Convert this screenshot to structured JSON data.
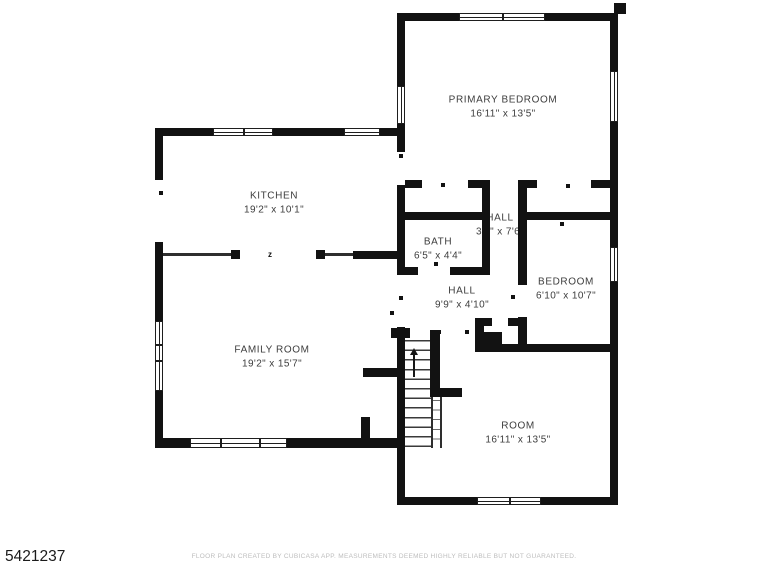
{
  "meta": {
    "background": "#ffffff",
    "wall_color": "#121212",
    "label_color": "#3d3d3d"
  },
  "rooms": [
    {
      "id": "primary-bedroom",
      "name": "PRIMARY BEDROOM",
      "dims": "16'11\" x 13'5\"",
      "cx": 503,
      "cy": 107
    },
    {
      "id": "kitchen",
      "name": "KITCHEN",
      "dims": "19'2\" x 10'1\"",
      "cx": 274,
      "cy": 203
    },
    {
      "id": "family-room",
      "name": "FAMILY ROOM",
      "dims": "19'2\" x 15'7\"",
      "cx": 272,
      "cy": 357
    },
    {
      "id": "bath",
      "name": "BATH",
      "dims": "6'5\" x 4'4\"",
      "cx": 438,
      "cy": 249
    },
    {
      "id": "hall-upper",
      "name": "HALL",
      "dims": "3'0\" x 7'6\"",
      "cx": 500,
      "cy": 225
    },
    {
      "id": "bedroom",
      "name": "BEDROOM",
      "dims": "6'10\" x 10'7\"",
      "cx": 566,
      "cy": 289
    },
    {
      "id": "hall-lower",
      "name": "HALL",
      "dims": "9'9\" x 4'10\"",
      "cx": 462,
      "cy": 298
    },
    {
      "id": "room",
      "name": "ROOM",
      "dims": "16'11\" x 13'5\"",
      "cx": 518,
      "cy": 433
    }
  ],
  "walls": [
    [
      610,
      13,
      8,
      492
    ],
    [
      397,
      13,
      8,
      492
    ],
    [
      155,
      128,
      8,
      320
    ],
    [
      482,
      188,
      8,
      87
    ],
    [
      518,
      180,
      9,
      172
    ],
    [
      430,
      330,
      10,
      67
    ],
    [
      361,
      417,
      9,
      27
    ],
    [
      475,
      318,
      9,
      34
    ],
    [
      397,
      13,
      221,
      8
    ],
    [
      614,
      3,
      12,
      11
    ],
    [
      155,
      128,
      250,
      8
    ],
    [
      397,
      180,
      221,
      8
    ],
    [
      397,
      212,
      93,
      8
    ],
    [
      518,
      212,
      100,
      8
    ],
    [
      397,
      267,
      93,
      8
    ],
    [
      231,
      250,
      9,
      9
    ],
    [
      316,
      250,
      9,
      9
    ],
    [
      353,
      251,
      52,
      8
    ],
    [
      155,
      438,
      250,
      10
    ],
    [
      475,
      344,
      143,
      8
    ],
    [
      475,
      318,
      17,
      8
    ],
    [
      508,
      318,
      19,
      8
    ],
    [
      391,
      328,
      19,
      10
    ],
    [
      430,
      388,
      32,
      9
    ],
    [
      363,
      368,
      42,
      9
    ],
    [
      397,
      497,
      221,
      8
    ],
    [
      475,
      332,
      27,
      16
    ]
  ],
  "thin_lines": [
    [
      163,
      253,
      68,
      3
    ],
    [
      325,
      253,
      28,
      3
    ],
    [
      431,
      397,
      2,
      51
    ],
    [
      440,
      397,
      2,
      51
    ]
  ],
  "gaps": [
    [
      397,
      152,
      8,
      33
    ],
    [
      155,
      180,
      8,
      62
    ],
    [
      397,
      275,
      8,
      52
    ],
    [
      422,
      180,
      46,
      8
    ],
    [
      490,
      180,
      28,
      8
    ],
    [
      537,
      180,
      54,
      8
    ],
    [
      418,
      267,
      32,
      8
    ],
    [
      518,
      285,
      9,
      32
    ]
  ],
  "windows": [
    {
      "r": [
        459,
        13,
        86,
        8
      ],
      "o": "h",
      "d": [
        0.5
      ]
    },
    {
      "r": [
        610,
        71,
        8,
        51
      ],
      "o": "v",
      "d": []
    },
    {
      "r": [
        397,
        86,
        8,
        38
      ],
      "o": "v",
      "d": []
    },
    {
      "r": [
        213,
        128,
        60,
        8
      ],
      "o": "h",
      "d": [
        0.5
      ]
    },
    {
      "r": [
        344,
        128,
        36,
        8
      ],
      "o": "h",
      "d": []
    },
    {
      "r": [
        155,
        321,
        8,
        70
      ],
      "o": "v",
      "d": [
        0.33,
        0.56
      ]
    },
    {
      "r": [
        190,
        438,
        97,
        10
      ],
      "o": "h",
      "d": [
        0.3,
        0.72
      ]
    },
    {
      "r": [
        610,
        247,
        8,
        35
      ],
      "o": "v",
      "d": []
    },
    {
      "r": [
        477,
        497,
        64,
        8
      ],
      "o": "h",
      "d": [
        0.5
      ]
    }
  ],
  "door_marks": [
    [
      159,
      191
    ],
    [
      159,
      311
    ],
    [
      399,
      154
    ],
    [
      441,
      183
    ],
    [
      566,
      184
    ],
    [
      560,
      222
    ],
    [
      511,
      295
    ],
    [
      434,
      262
    ],
    [
      465,
      330
    ],
    [
      437,
      330
    ],
    [
      399,
      296
    ],
    [
      390,
      311
    ]
  ],
  "stairs": {
    "treads": [
      405,
      340,
      26,
      108
    ],
    "side": [
      433,
      400,
      7,
      48
    ],
    "arrow_head": [
      410,
      348
    ],
    "arrow_stem": [
      413,
      355,
      2,
      22
    ]
  },
  "door_swing_mark": {
    "label": "z",
    "x": 268,
    "y": 251
  },
  "footer": {
    "disclaimer": "FLOOR PLAN CREATED BY CUBICASA APP. MEASUREMENTS DEEMED HIGHLY RELIABLE BUT NOT GUARANTEED.",
    "plan_id": "5421237"
  }
}
